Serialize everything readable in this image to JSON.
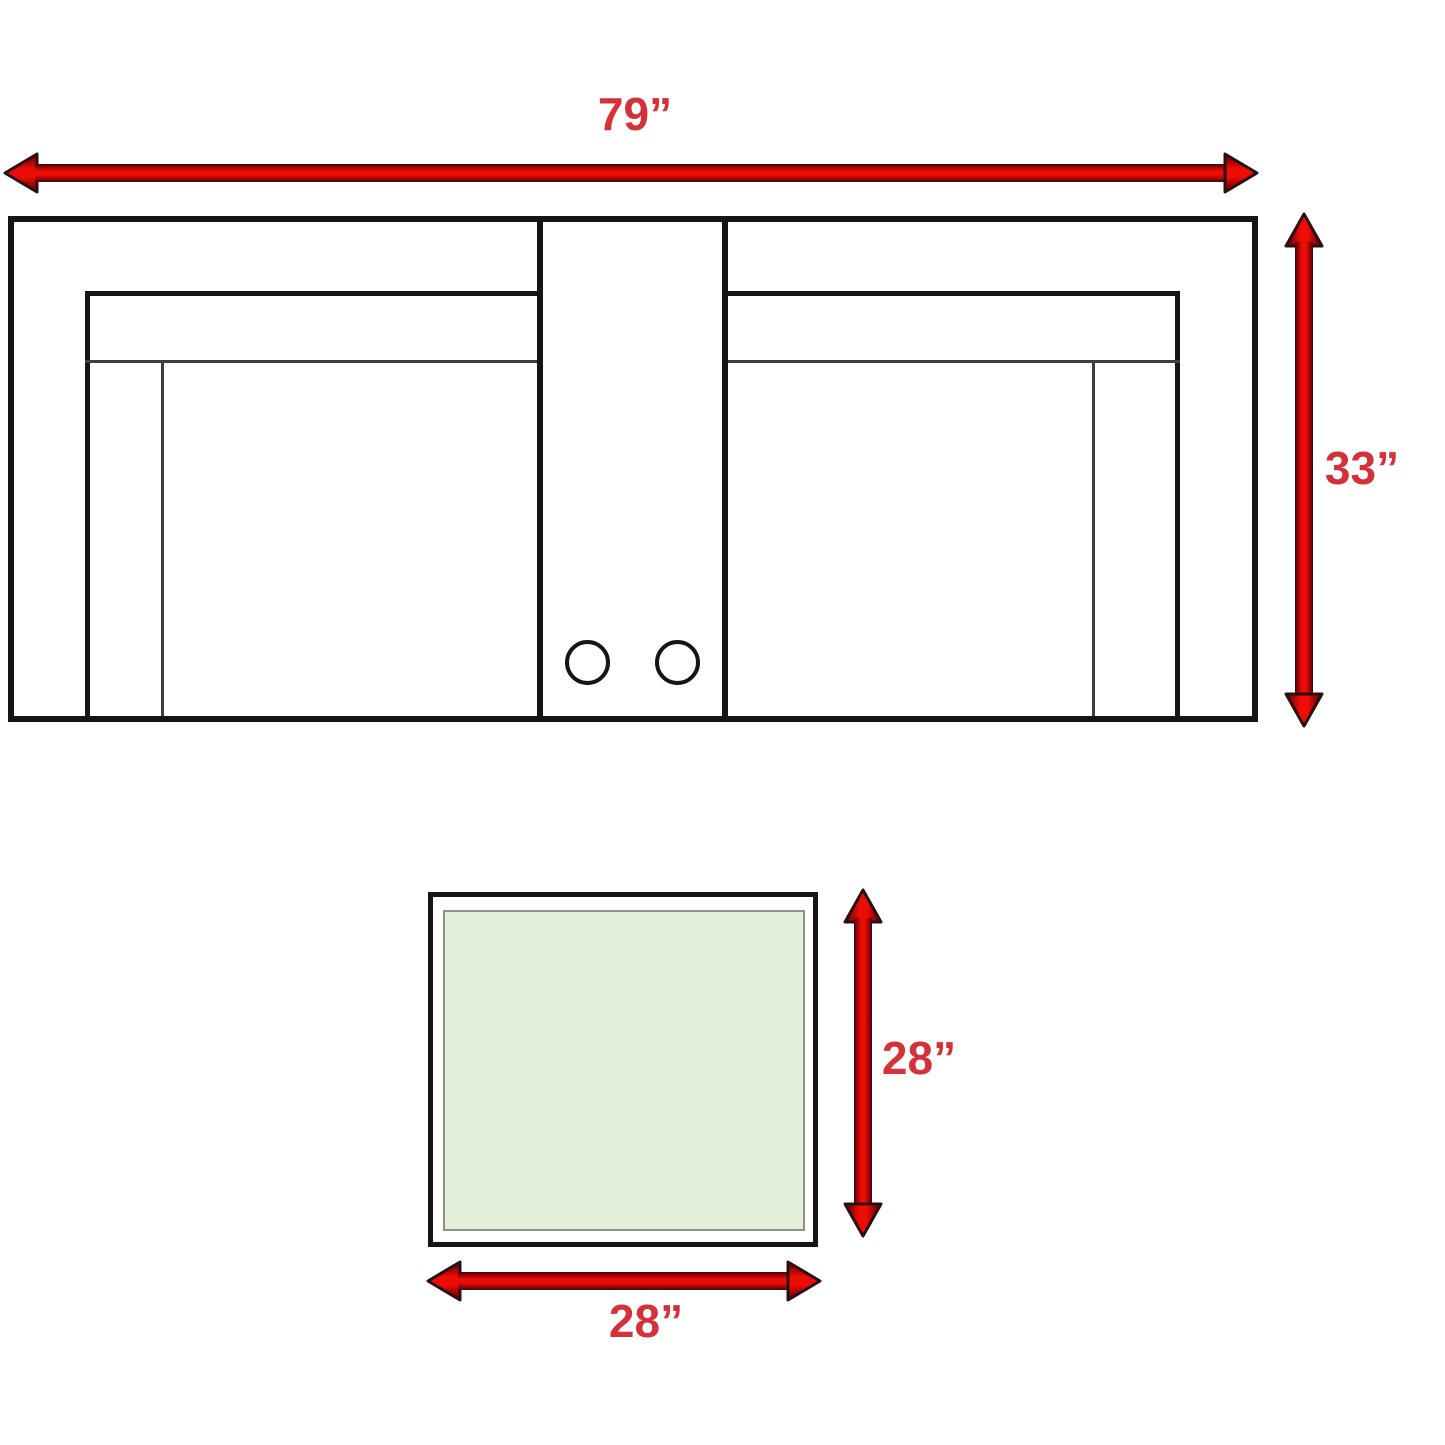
{
  "colors": {
    "background": "#ffffff",
    "label_red": "#d43238",
    "arrow_red_bright": "#ee0d05",
    "arrow_red_dark": "#8f0207",
    "arrow_outline": "#2a0f10",
    "line_black": "#151515",
    "line_gray": "#3f3f3f",
    "table_fill_green": "#e3efdb",
    "table_inner_border": "#8d938a"
  },
  "icons": {
    "horizontal_dimension_arrow": "double-headed-arrow-left-right",
    "vertical_dimension_arrow": "double-headed-arrow-up-down"
  },
  "sofa_diagram": {
    "width_label": "79”",
    "height_label": "33”"
  },
  "table_diagram": {
    "width_label": "28”",
    "height_label": "28”"
  }
}
